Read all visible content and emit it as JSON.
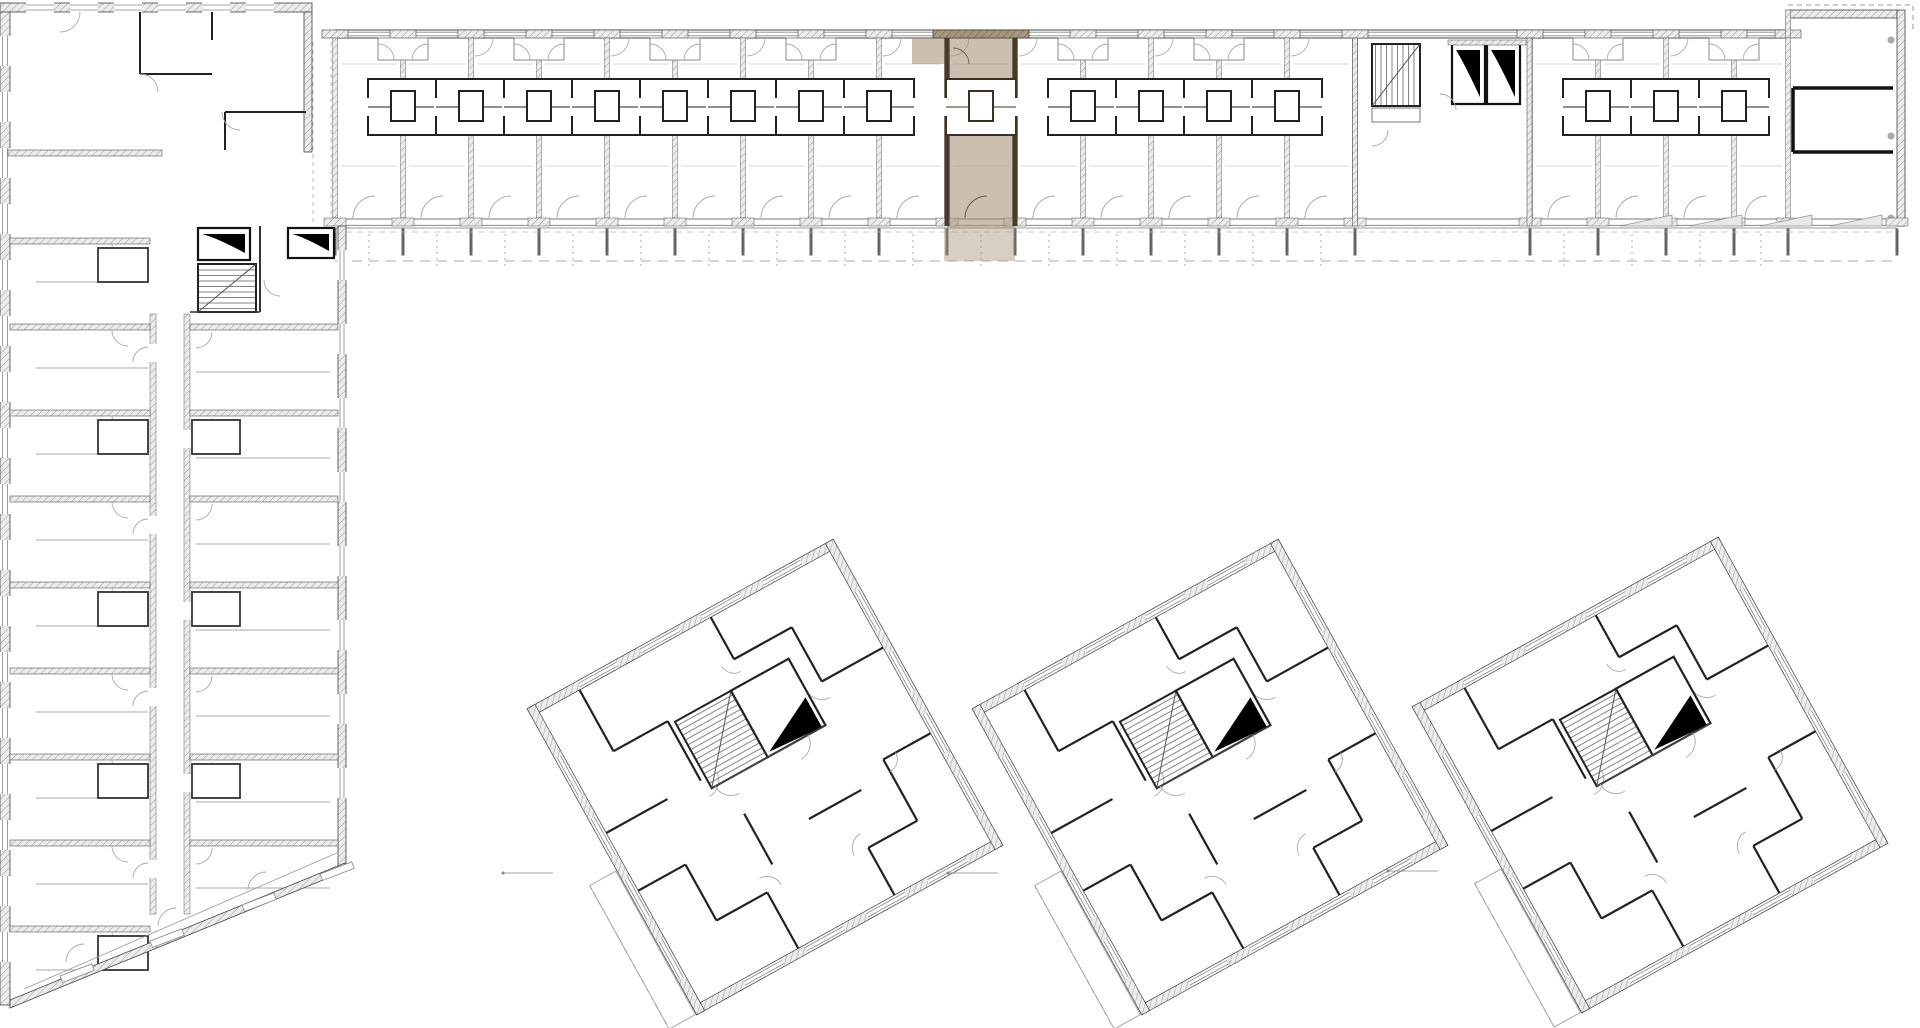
{
  "meta": {
    "title": "",
    "type": "architectural-floor-plan",
    "elements": [
      "l-shaped-slab-building",
      "highlighted-apartment-unit",
      "stair-cores",
      "elevator-shafts",
      "three-rotated-towers",
      "balcony-strip"
    ]
  },
  "colors": {
    "background": "#ffffff",
    "wall_dark": "#222222",
    "wall_medium": "#555555",
    "line_light": "#999999",
    "line_faint": "#bbbbbb",
    "hatch_fill": "#ececec",
    "hatch_line": "#9a9a9a",
    "highlight_fill": "#a08c6d",
    "highlight_wall": "#473b2c",
    "highlight_hatch_fill": "#a3937a",
    "highlight_hatch_line": "#6f6048",
    "elevator_glyph": "#000000"
  },
  "bar": {
    "top": 30,
    "wall_b1": 38,
    "unit_bottom": 218,
    "wall_b2": 226,
    "balcony_line": 228,
    "balcony_bottom": 261,
    "dash_y1": 232,
    "dash_y2": 261,
    "x_start": 335,
    "x_end": 1897,
    "boundaries_left": [
      335,
      403,
      471,
      539,
      607,
      675,
      743,
      811,
      879,
      947,
      1015,
      1083,
      1151,
      1219,
      1287,
      1355
    ],
    "core_zone": [
      1355,
      1530
    ],
    "boundaries_right": [
      1530,
      1598,
      1666,
      1734,
      1788
    ],
    "end_block": {
      "x1": 1788,
      "x2": 1897,
      "top": 10
    },
    "niche_dividers": [
      403,
      539,
      675,
      811,
      1083,
      1219,
      1598,
      1734
    ],
    "screen_triangles_x": [
      1620,
      1690,
      1760,
      1830
    ],
    "connector_x": [
      313,
      331
    ]
  },
  "highlight": {
    "x1": 947,
    "x2": 1015,
    "y1": 30,
    "y2": 228,
    "balcony": [
      944,
      228,
      71,
      33
    ],
    "entry_tab": [
      912,
      38,
      35,
      26
    ],
    "top_band": [
      933,
      30,
      96,
      8
    ],
    "pod_x": 981
  },
  "bar_core": {
    "wall_l": 1355,
    "wall_r": 1527,
    "stair": [
      1372,
      44,
      48,
      62
    ],
    "landing": [
      1372,
      108,
      48,
      14
    ],
    "lifts": [
      [
        1452,
        44,
        33,
        60
      ],
      [
        1487,
        44,
        33,
        60
      ]
    ]
  },
  "junction_core": {
    "lifts": [
      [
        198,
        228,
        52,
        32
      ],
      [
        288,
        228,
        46,
        30
      ]
    ],
    "stair": [
      198,
      264,
      58,
      48
    ]
  },
  "left_wing": {
    "block": {
      "x": 0,
      "y": 3,
      "w": 312,
      "h": 149
    },
    "left_wall": [
      0,
      3,
      10,
      1002
    ],
    "right_wall": [
      338,
      226,
      8,
      642
    ],
    "corridor": {
      "xa": 150,
      "xb": 184,
      "w": 6,
      "y1": 314,
      "y2": 914
    },
    "left_dividers": [
      238,
      324,
      410,
      496,
      582,
      668,
      754,
      840,
      926
    ],
    "right_dividers": [
      324,
      410,
      496,
      582,
      668,
      754,
      840
    ],
    "diagonal": [
      [
        10,
        1003
      ],
      [
        345,
        866
      ]
    ],
    "block_walls": [
      [
        140,
        12,
        140,
        74
      ],
      [
        140,
        74,
        212,
        74
      ],
      [
        212,
        12,
        212,
        40
      ],
      [
        225,
        112,
        306,
        112
      ],
      [
        225,
        112,
        225,
        150
      ]
    ],
    "end_wall_thick": [
      [
        1793,
        88,
        1893,
        88
      ],
      [
        1793,
        152,
        1893,
        152
      ],
      [
        1793,
        88,
        1793,
        152
      ]
    ]
  },
  "towers": {
    "side": 350,
    "rotation_deg": -29,
    "centers": [
      [
        765,
        777
      ],
      [
        1210,
        777
      ],
      [
        1650,
        775
      ]
    ],
    "window_offsets": [
      -118,
      -48,
      22,
      92
    ],
    "interior_walls": [
      [
        -120,
        -166,
        -120,
        -96
      ],
      [
        -120,
        -96,
        -58,
        -96
      ],
      [
        -58,
        -96,
        -58,
        -28
      ],
      [
        -166,
        -28,
        -96,
        -28
      ],
      [
        30,
        -166,
        30,
        -118
      ],
      [
        30,
        -118,
        96,
        -118
      ],
      [
        96,
        -118,
        96,
        -56
      ],
      [
        96,
        -56,
        166,
        -56
      ],
      [
        58,
        -56,
        58,
        -18
      ],
      [
        -166,
        38,
        -112,
        38
      ],
      [
        -112,
        38,
        -112,
        102
      ],
      [
        -112,
        102,
        -54,
        102
      ],
      [
        -54,
        102,
        -54,
        166
      ],
      [
        -36,
        22,
        -36,
        80
      ],
      [
        166,
        42,
        112,
        42
      ],
      [
        112,
        42,
        112,
        112
      ],
      [
        112,
        112,
        56,
        112
      ],
      [
        56,
        112,
        56,
        166
      ],
      [
        18,
        58,
        78,
        58
      ]
    ]
  }
}
